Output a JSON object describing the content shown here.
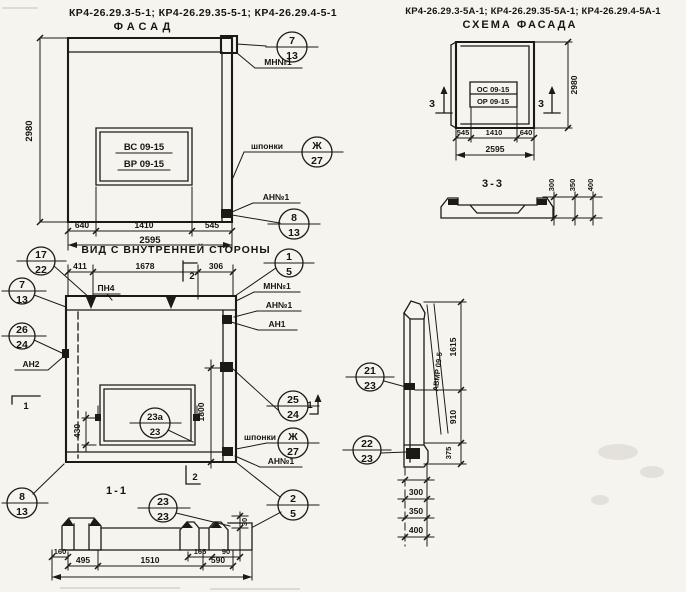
{
  "titles": {
    "left_codes": "КР4-26.29.3-5-1; КР4-26.29.35-5-1; КР4-26.29.4-5-1",
    "facade": "ФАСАД",
    "right_codes": "КР4-26.29.3-5А-1; КР4-26.29.35-5А-1; КР4-26.29.4-5А-1",
    "scheme": "СХЕМА ФАСАДА",
    "inner": "ВИД С ВНУТРЕННЕЙ СТОРОНЫ",
    "sec11": "1-1",
    "sec33": "3-3"
  },
  "facade": {
    "height": "2980",
    "d1": "640",
    "d2": "1410",
    "d3": "545",
    "total": "2595",
    "win1": "ВС 09-15",
    "win2": "ВР 09-15",
    "lbl_mn": "МН№1",
    "lbl_an": "АН№1",
    "lbl_shp": "шпонки",
    "b1t": "7",
    "b1b": "13",
    "b2t": "Ж",
    "b2b": "27",
    "b3t": "8",
    "b3b": "13"
  },
  "scheme": {
    "height": "2980",
    "d1": "545",
    "d2": "1410",
    "d3": "640",
    "total": "2595",
    "win1": "ОС 09-15",
    "win2": "ОР 09-15",
    "sec_left": "3",
    "sec_right": "3"
  },
  "sec33": {
    "d1": "300",
    "d2": "350",
    "d3": "400"
  },
  "inner": {
    "d1": "411",
    "d2": "1678",
    "d3": "306",
    "pn": "ПН4",
    "lbl_an2": "АН2",
    "lbl_mn": "МН№1",
    "lbl_an": "АН№1",
    "lbl_an1": "АН1",
    "lbl_shp": "шпонки",
    "lbl_an_b": "АН№1",
    "dim_w": "430",
    "dim_h": "1800",
    "b17t": "17",
    "b17b": "22",
    "b7t": "7",
    "b7b": "13",
    "b26t": "26",
    "b26b": "24",
    "b8t": "8",
    "b8b": "13",
    "b1t": "1",
    "b1b": "5",
    "b25t": "25",
    "b25b": "24",
    "bsht": "Ж",
    "bshb": "27",
    "b2t": "2",
    "b2b": "5",
    "bwt": "23а",
    "bwb": "23",
    "sec1": "1",
    "sec1r": "1",
    "sec2": "2",
    "sec2b": "2"
  },
  "profile": {
    "band": "АВМР 09-5",
    "d1": "1615",
    "d2": "910",
    "d3": "375",
    "s1": "300",
    "s2": "350",
    "s3": "400",
    "b21t": "21",
    "b21b": "23",
    "b22t": "22",
    "b22b": "23"
  },
  "sec11": {
    "d160": "160",
    "d495": "495",
    "d1510": "1510",
    "d165": "165",
    "d90": "90",
    "d590": "590",
    "d30": "30",
    "bt": "23",
    "bb": "23"
  }
}
